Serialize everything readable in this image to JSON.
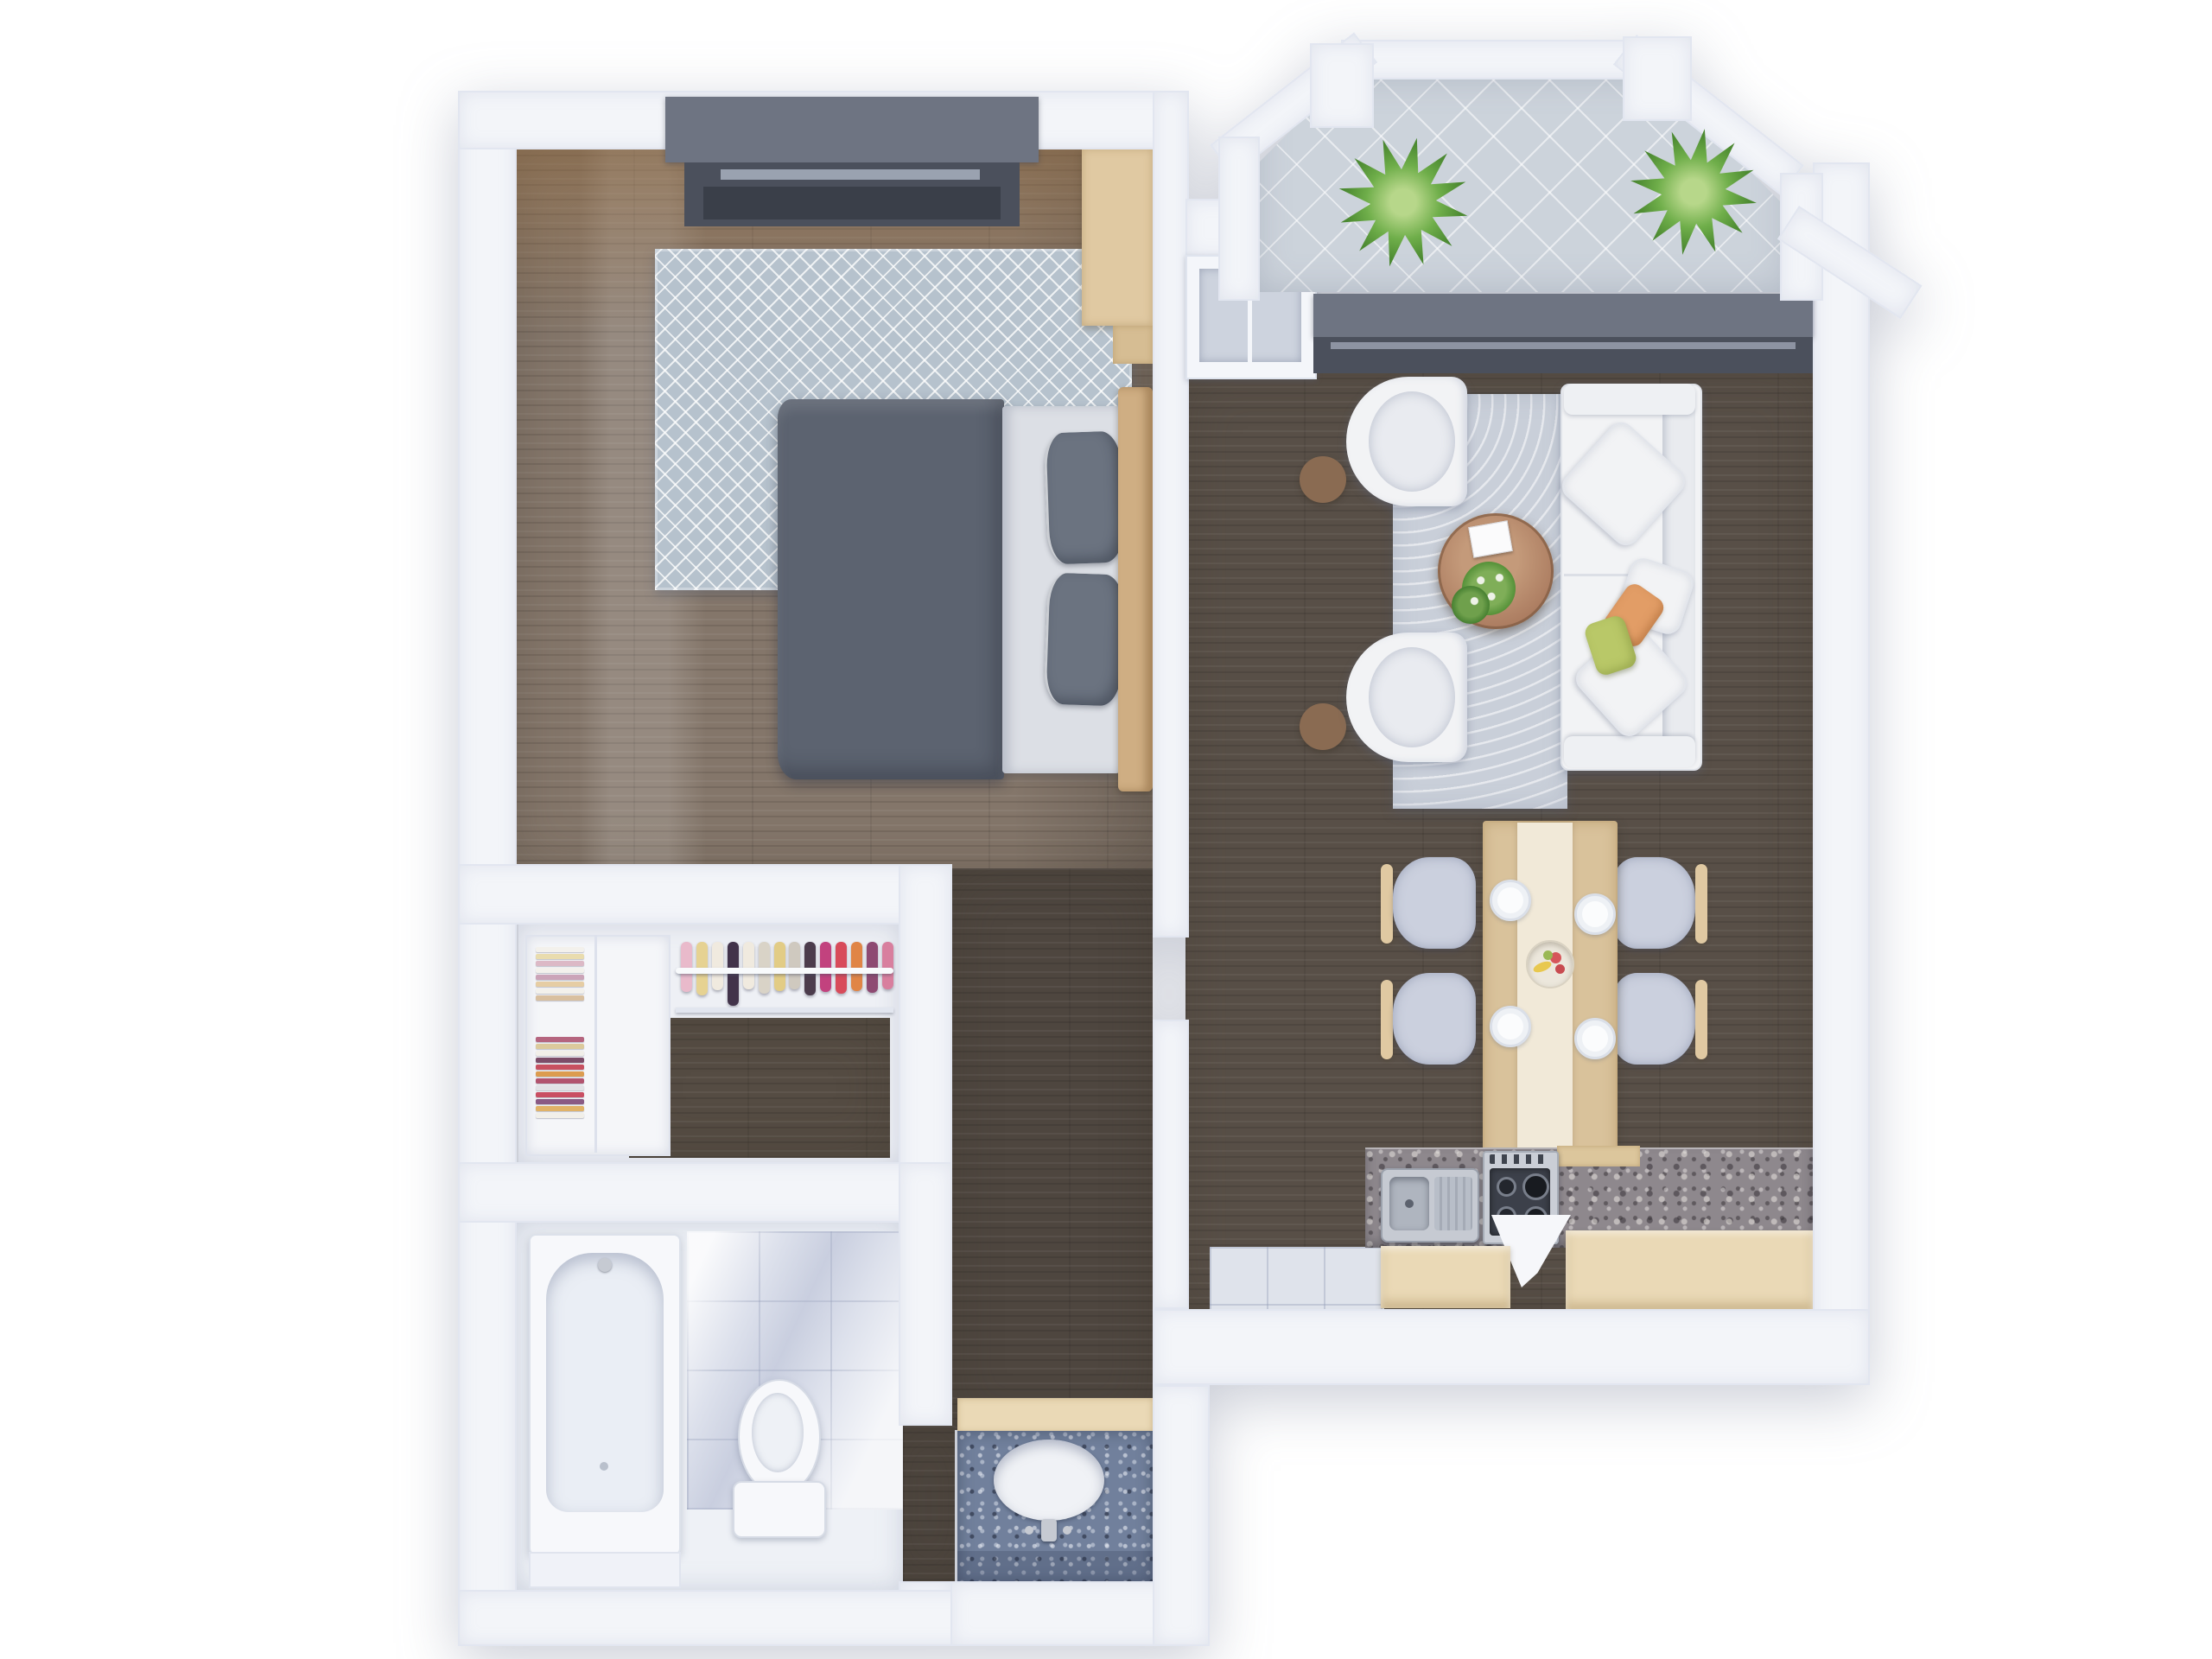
{
  "scene": {
    "kind": "3d-rendered-floor-plan",
    "view": "top-down",
    "background": "#ffffff"
  },
  "palette": {
    "wall": "#f3f5f9",
    "wall_edge": "#e2e6f0",
    "wood_bedroom": "#84766a",
    "wood_living": "#584f47",
    "wood_corridor": "#4e463f",
    "wood_closet": "#554c43",
    "rug_bedroom": "#b6c2cd",
    "rug_living": "#c9cfd9",
    "balcony_tile": "#ccd3db",
    "entry_tile": "#dfe3eb",
    "marble": "#dde1ec",
    "granite_kitchen": "#8e888d",
    "granite_vanity": "#71809c",
    "window_band": "#6e7482",
    "window_frame_dark": "#4b505c",
    "duvet": "#5c6370",
    "pillow": "#6b7380",
    "sheet": "#dcdfe5",
    "headboard": "#cfae83",
    "desk_wood": "#e0c9a2",
    "cabinet_wood": "#ead9b6",
    "sofa_white": "#f2f3f5",
    "cushion": "#e9ebf0",
    "accent_green": "#b9c868",
    "accent_orange": "#e29d66",
    "table_wood": "#d9c29b",
    "table_runner": "#f1e9d8",
    "chair_seat": "#cbd0de",
    "coffee_table_wood": "#ad7e62",
    "side_table_wood": "#8a6b52",
    "plant": "#4e8c33",
    "steel": "#c6cad2",
    "white_fixture": "#f7f8fb"
  },
  "rooms": [
    {
      "id": "bedroom",
      "furniture": [
        "double-bed",
        "duvet",
        "pillows",
        "headboard",
        "area-rug",
        "window",
        "desk"
      ]
    },
    {
      "id": "walk-in-closet",
      "furniture": [
        "shelves",
        "folded-clothes",
        "hanging-rail",
        "garments"
      ]
    },
    {
      "id": "bathroom",
      "furniture": [
        "bathtub",
        "toilet",
        "marble-tiling"
      ]
    },
    {
      "id": "hallway",
      "furniture": [
        "vanity-counter",
        "sink",
        "faucet"
      ]
    },
    {
      "id": "living-room",
      "furniture": [
        "sofa",
        "armchair",
        "armchair",
        "coffee-table",
        "flowers",
        "area-rug",
        "side-tables"
      ]
    },
    {
      "id": "dining-area",
      "furniture": [
        "dining-table",
        "runner",
        "fruit-bowl",
        "chairs"
      ]
    },
    {
      "id": "kitchen",
      "furniture": [
        "granite-counter",
        "double-sink",
        "gas-stove",
        "cabinets"
      ]
    },
    {
      "id": "balcony",
      "furniture": [
        "plant",
        "plant",
        "railing",
        "tiled-floor"
      ]
    }
  ],
  "closet": {
    "folded_stacks": [
      {
        "colors": [
          "#f3f1ec",
          "#e9dcae",
          "#dcb9c6",
          "#f3f1ec",
          "#cba4b8",
          "#e6cda4",
          "#f3f1ec",
          "#d9c0a0"
        ]
      },
      {
        "colors": [
          "#b5657f",
          "#dcca9c",
          "#f1efe9",
          "#7c4c68",
          "#c75060",
          "#dc9c50",
          "#b2546f",
          "#e2e2e6",
          "#c94f63",
          "#8a5a84",
          "#e0b268",
          "#f1efe9"
        ]
      }
    ],
    "hanging_items": [
      {
        "color": "#e9bacb",
        "h": 58
      },
      {
        "color": "#e6d292",
        "h": 62
      },
      {
        "color": "#f0eadf",
        "h": 56
      },
      {
        "color": "#42334a",
        "h": 74
      },
      {
        "color": "#f0eadf",
        "h": 55
      },
      {
        "color": "#d9d3c7",
        "h": 60
      },
      {
        "color": "#e2cc86",
        "h": 57
      },
      {
        "color": "#cfc9bf",
        "h": 55
      },
      {
        "color": "#4c3c4c",
        "h": 62
      },
      {
        "color": "#c2427e",
        "h": 58
      },
      {
        "color": "#d84b5a",
        "h": 60
      },
      {
        "color": "#e08546",
        "h": 57
      },
      {
        "color": "#8e4a72",
        "h": 59
      },
      {
        "color": "#d87f9e",
        "h": 55
      }
    ]
  },
  "dining": {
    "plates": 4,
    "chairs": 4,
    "fruit_bowl": true
  },
  "balcony": {
    "plants": 2
  }
}
